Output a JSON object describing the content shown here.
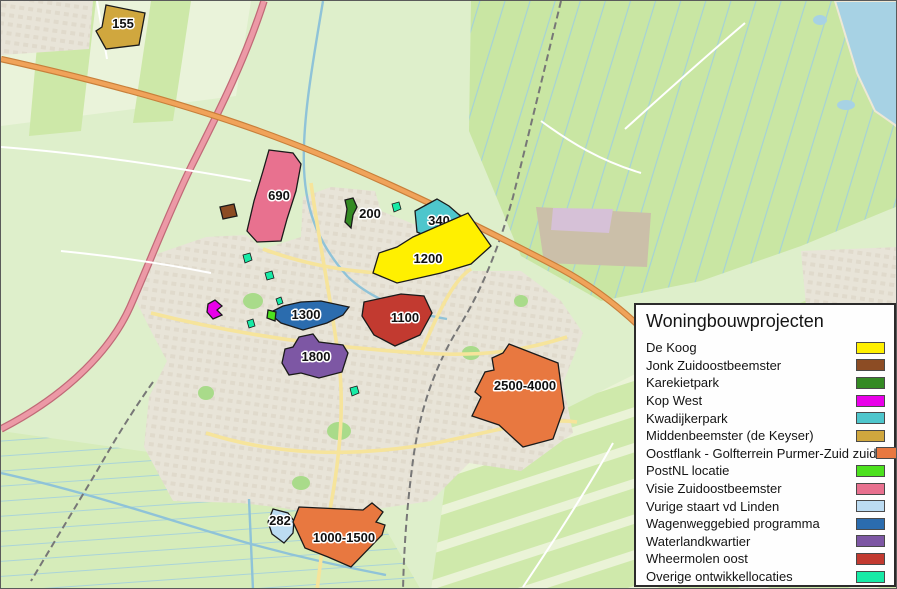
{
  "legend": {
    "title": "Woningbouwprojecten",
    "items": [
      {
        "label": "De Koog",
        "color": "#FFF000"
      },
      {
        "label": "Jonk Zuidoostbeemster",
        "color": "#8C4C24"
      },
      {
        "label": "Karekietpark",
        "color": "#348A23"
      },
      {
        "label": "Kop West",
        "color": "#E900E9"
      },
      {
        "label": "Kwadijkerpark",
        "color": "#4EC6CC"
      },
      {
        "label": "Middenbeemster (de Keyser)",
        "color": "#D0A73E"
      },
      {
        "label": "Oostflank - Golfterrein Purmer-Zuid zuid",
        "color": "#E87840"
      },
      {
        "label": "PostNL locatie",
        "color": "#4CE11E"
      },
      {
        "label": "Visie Zuidoostbeemster",
        "color": "#E8718F"
      },
      {
        "label": "Vurige staart vd Linden",
        "color": "#BCDCF2"
      },
      {
        "label": "Wagenweggebied programma",
        "color": "#2B6CAE"
      },
      {
        "label": "Waterlandkwartier",
        "color": "#7D57A4"
      },
      {
        "label": "Wheermolen oost",
        "color": "#C23A30"
      },
      {
        "label": "Overige ontwikkellocaties",
        "color": "#17EAA6"
      }
    ]
  },
  "map": {
    "palette": {
      "field_base": "#DEEFCB",
      "field_dark": "#C9E6A3",
      "field_pale": "#EDF4DC",
      "water": "#A7D2E4",
      "urban": "#E8E4D8",
      "urban_blocks": "#D9D2C2",
      "industrial": "#CBBFA9",
      "retail_zone": "#D6C1D7",
      "park": "#A9DB8A",
      "motorway": "#EC99A6",
      "highway": "#F0A35A",
      "road_yellow": "#F6E49B",
      "road_white": "#FFFFFF",
      "railway": "#777777",
      "canal": "#8FC3D8"
    },
    "projects": [
      {
        "name": "Middenbeemster (de Keyser)",
        "units": "155",
        "color": "#D0A73E",
        "points": "105,4 144,12 138,44 105,48 95,30 101,26",
        "lx": 122,
        "ly": 27
      },
      {
        "name": "Visie Zuidoostbeemster",
        "units": "690",
        "color": "#E8718F",
        "points": "268,149 292,152 300,163 295,190 286,218 280,240 256,241 246,230 253,200 262,170",
        "lx": 278,
        "ly": 199
      },
      {
        "name": "Jonk Zuidoostbeemster",
        "units": "",
        "color": "#8C4C24",
        "points": "219,206 233,203 236,215 222,218"
      },
      {
        "name": "Karekietpark",
        "units": "200",
        "color": "#348A23",
        "points": "344,199 352,197 356,206 352,214 350,227 344,221 346,208",
        "lx": 369,
        "ly": 217
      },
      {
        "name": "Kwadijkerpark",
        "units": "340",
        "color": "#4EC6CC",
        "points": "414,210 436,198 448,205 464,219 456,230 430,237 416,231",
        "lx": 438,
        "ly": 224
      },
      {
        "name": "De Koog",
        "units": "1200",
        "color": "#FFF000",
        "points": "412,236 467,212 490,245 470,263 440,272 396,282 372,272 378,252 396,246",
        "lx": 427,
        "ly": 262
      },
      {
        "name": "Wheermolen oost",
        "units": "1100",
        "color": "#C23A30",
        "points": "363,301 400,293 423,295 431,312 419,334 394,345 373,334 361,315",
        "lx": 404,
        "ly": 321
      },
      {
        "name": "Wagenweggebied programma",
        "units": "1300",
        "color": "#2B6CAE",
        "points": "268,312 282,305 300,301 320,300 348,306 342,314 326,322 302,329 280,322",
        "lx": 305,
        "ly": 318
      },
      {
        "name": "Waterlandkwartier",
        "units": "1800",
        "color": "#7D57A4",
        "points": "298,336 312,333 318,341 342,344 347,352 341,371 318,377 300,372 288,374 281,362 284,348 292,346",
        "lx": 315,
        "ly": 360
      },
      {
        "name": "Oostflank - Golfterrein Purmer-Zuid zuid",
        "units": "2500-4000",
        "color": "#E87840",
        "points": "508,343 557,362 563,407 552,438 522,446 498,424 471,415 480,396 474,391 484,371 493,369 491,357 502,352",
        "lx": 524,
        "ly": 389
      },
      {
        "name": "Vurige staart vd Linden",
        "units": "282",
        "color": "#BCDCF2",
        "points": "272,508 287,512 293,520 292,532 283,542 271,533 267,521",
        "lx": 279,
        "ly": 524
      },
      {
        "name": "Oostflank - Golfterrein Purmer-Zuid zuid",
        "units": "1000-1500",
        "color": "#E87840",
        "points": "298,506 362,509 371,502 382,511 375,521 384,524 381,534 350,566 327,556 304,547 292,521",
        "lx": 343,
        "ly": 541
      },
      {
        "name": "Kop West",
        "units": "",
        "color": "#E900E9",
        "points": "207,303 214,299 221,305 216,309 221,314 212,318 206,311"
      },
      {
        "name": "PostNL locatie",
        "units": "",
        "color": "#4CE11E",
        "points": "267,309 275,311 274,320 266,317"
      }
    ],
    "other_sites": {
      "name": "Overige ontwikkellocaties",
      "color": "#17EAA6",
      "shapes": [
        "242,254 249,252 251,259 244,262",
        "264,272 271,270 273,277 266,279",
        "391,203 398,201 400,208 393,211",
        "349,387 356,385 358,392 351,395",
        "275,298 280,296 282,302 277,304",
        "246,320 252,318 254,325 248,327"
      ]
    }
  }
}
